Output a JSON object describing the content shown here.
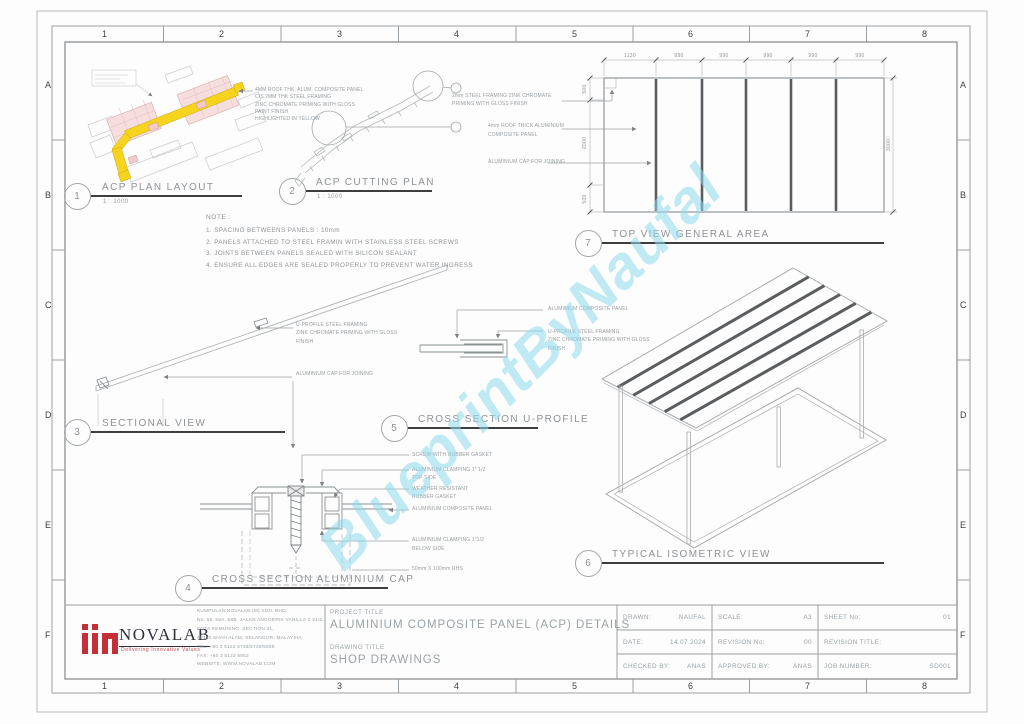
{
  "sheet": {
    "watermark": "BlueprintByNaufal",
    "grid_cols": [
      "1",
      "2",
      "3",
      "4",
      "5",
      "6",
      "7",
      "8"
    ],
    "grid_rows": [
      "A",
      "B",
      "C",
      "D",
      "E",
      "F"
    ]
  },
  "colors": {
    "highlight_yellow": "#f6d41e",
    "zone_pink": "#f7dede",
    "logo_red": "#c53038",
    "watermark_cyan": "#8ed9ec"
  },
  "note": {
    "heading": "NOTE :",
    "items": [
      "1. SPACING BETWEENS PANELS : 10mm",
      "2. PANELS ATTACHED TO STEEL FRAMIN WITH STAINLESS STEEL SCREWS",
      "3. JOINTS BETWEEN PANELS SEALED WITH SILICON SEALANT",
      "4. ENSURE ALL EDGES ARE SEALED PROPERLY TO PREVENT WATER INGRESS"
    ]
  },
  "views": {
    "plan_layout": {
      "num": "1",
      "title": "ACP PLAN LAYOUT",
      "scale": "1 : 1000",
      "callout": [
        "4MM ROOF THK. ALUM. COMPOSITE PANEL",
        "C/S 2MM THK STEEL FRAMING",
        "ZINC CHROMATE PRIMING WITH GLOSS",
        "PAINT FINISH",
        "HIGHLIGHTED IN YELLOW"
      ]
    },
    "cutting_plan": {
      "num": "2",
      "title": "ACP CUTTING PLAN",
      "scale": "1 : 1000"
    },
    "sectional": {
      "num": "3",
      "title": "SECTIONAL VIEW",
      "labels": {
        "u_profile_1": "U-PROFILE STEEL FRAMING",
        "u_profile_2": "ZINK CHROMATE PRIMING WITH GLOSS",
        "u_profile_3": "FINISH",
        "cap": "ALUMINIUM CAP FOR JOINING"
      }
    },
    "cap_section": {
      "num": "4",
      "title": "CROSS SECTION ALUMINIUM CAP",
      "labels": {
        "screw": "SCREW WITH RUBBER GASKET",
        "clamp_top_1": "ALUMINIUM CLAMPING 1\" 1/2",
        "clamp_top_2": "TOP SIDE",
        "gasket_1": "WEATHER RESISTANT",
        "gasket_2": "RUBBER GASKET",
        "panel": "ALUMINIUM COMPOSITE PANEL",
        "clamp_below_1": "ALUMINIUM CLAMPING 1\"1/2",
        "clamp_below_2": "BELOW SIDE",
        "rhs": "50mm X 100mm RHS"
      }
    },
    "u_profile": {
      "num": "5",
      "title": "CROSS SECTION U-PROFILE",
      "labels": {
        "panel": "ALUMINIUM COMPOSITE PANEL",
        "framing_1": "U-PROFILE STEEL FRAMING",
        "framing_2": "ZINC CHROMATE PRIMING WITH GLOSS",
        "framing_3": "FINISH"
      }
    },
    "isometric": {
      "num": "6",
      "title": "TYPICAL ISOMETRIC VIEW"
    },
    "top_view": {
      "num": "7",
      "title": "TOP VIEW GENERAL AREA",
      "labels": {
        "framing_1": "2mm STEEL FRAMING ZINK CHROMATE",
        "framing_2": "PRIMING WITH GLOSS FINISH",
        "panel_1": "4mm ROOF THICK ALUMINIUM",
        "panel_2": "COMPOSITE PANEL",
        "cap": "ALUMINIUM CAP FOR JOINING"
      },
      "dims": {
        "top": [
          "1130",
          "990",
          "990",
          "990",
          "990",
          "990"
        ],
        "left": [
          "500",
          "2000",
          "500"
        ],
        "right": "3000"
      }
    }
  },
  "title_block": {
    "company": {
      "name": "NOVALAB",
      "tagline": "Delivering Innovative Values",
      "info": [
        "KUMPULAN NOVALAB (M) SDN. BHD.",
        "No. 68, 68A, 68B, JALAN ANGGERIK VANILLA Z 31/Z,",
        "KOTA KEMUNING, SECTION 31,",
        "40460 SHAH ALAM, SELANGOR, MALAYSIA",
        "TEL: +60 3 5122 5738/5739/5855",
        "FAX: +60 3 5122 5852",
        "WEBSITE: WWW.NOVALAB.COM"
      ]
    },
    "project_title_label": "PROJECT TITLE",
    "project_title": "ALUMINIUM COMPOSITE PANEL (ACP) DETAILS",
    "drawing_title_label": "DRAWING TITLE",
    "drawing_title": "SHOP DRAWINGS",
    "meta": {
      "drawn_label": "DRAWN:",
      "drawn": "NAUFAL",
      "scale_label": "SCALE:",
      "scale": "A3",
      "sheet_label": "SHEET No:",
      "sheet": "01",
      "date_label": "DATE:",
      "date": "14.07.2024",
      "rev_no_label": "REVISION No:",
      "rev_no": "00",
      "rev_title_label": "REVISION TITLE:",
      "rev_title": "",
      "checked_label": "CHECKED BY:",
      "checked": "ANAS",
      "approved_label": "APPROVED BY:",
      "approved": "ANAS",
      "job_label": "JOB NUMBER:",
      "job": "SD001"
    }
  }
}
